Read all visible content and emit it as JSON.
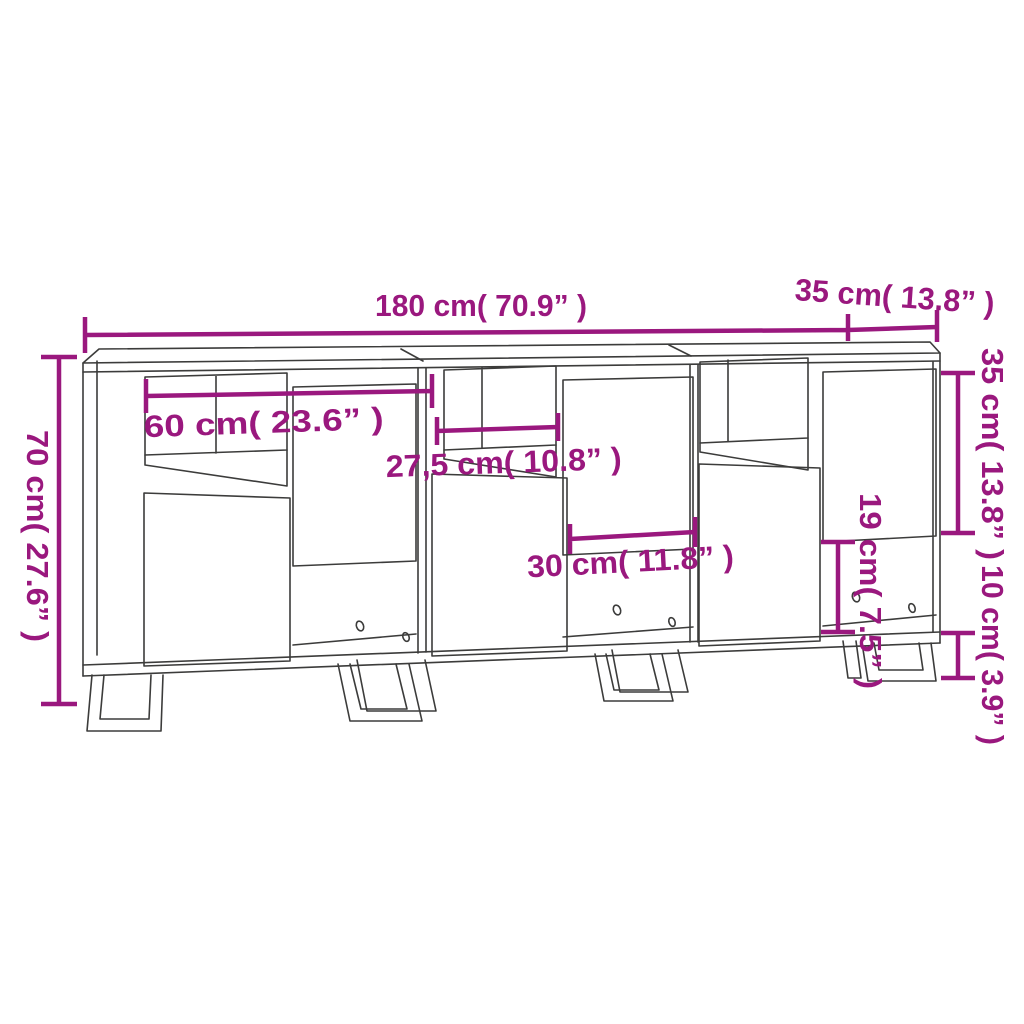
{
  "diagram": {
    "type": "furniture-dimension-drawing",
    "product": "3-piece sideboard with metal legs",
    "background": "#ffffff",
    "colors": {
      "dimension_annotation": "#9A187E",
      "drawing_lines": "#3C3C3B"
    }
  },
  "dims": {
    "total_width": {
      "label": "180 cm( 70.9” )",
      "value_cm": "180",
      "value_inch": "70.9"
    },
    "top_depth": {
      "label": "35 cm( 13.8” )",
      "value_cm": "35",
      "value_inch": "13.8"
    },
    "total_height": {
      "label": "70 cm( 27.6” )",
      "value_cm": "70",
      "value_inch": "27.6"
    },
    "unit_width": {
      "label": "60 cm( 23.6” )",
      "value_cm": "60",
      "value_inch": "23.6"
    },
    "shelf_width": {
      "label": "27,5 cm( 10.8” )",
      "value_cm": "27,5",
      "value_inch": "10.8"
    },
    "door_width": {
      "label": "30 cm( 11.8” )",
      "value_cm": "30",
      "value_inch": "11.8"
    },
    "door_height": {
      "label": "35 cm( 13.8” )",
      "value_cm": "35",
      "value_inch": "13.8"
    },
    "open_space_height": {
      "label": "19 cm( 7.5” )",
      "value_cm": "19",
      "value_inch": "7.5"
    },
    "leg_height": {
      "label": "10 cm( 3.9” )",
      "value_cm": "10",
      "value_inch": "3.9"
    }
  }
}
